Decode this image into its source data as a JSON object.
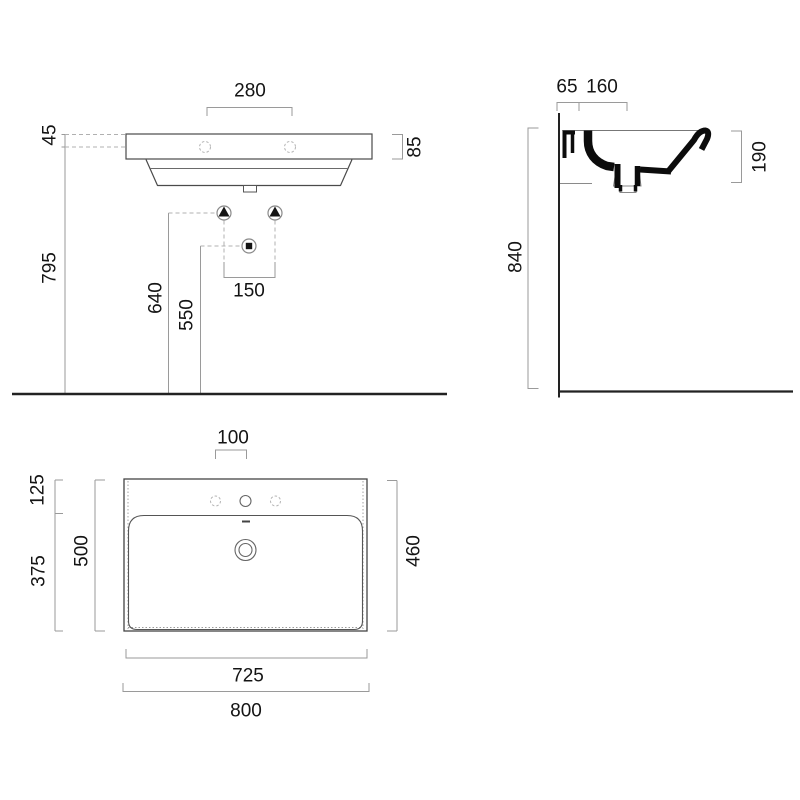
{
  "colors": {
    "background": "#ffffff",
    "outline": "#4a4a4a",
    "section_fill": "#0c0c0c",
    "dimension_line": "#9a9a9a",
    "hidden_line": "#b5b5b5",
    "wall_floor_line": "#222222",
    "text": "#141414"
  },
  "symbols": {
    "water_supply": "triangle-in-circle",
    "waste_outlet": "square-in-circle"
  },
  "front_view": {
    "dims": {
      "hole_spacing": "280",
      "hole_to_rim": "45",
      "rim_height": "85",
      "hole_height": "795",
      "supply_height": "640",
      "waste_height": "550",
      "supply_spacing": "150"
    }
  },
  "side_view": {
    "dims": {
      "wall_to_fixing": "65",
      "fixing_to_waste": "160",
      "basin_depth": "190",
      "rim_height_from_floor": "840"
    }
  },
  "plan_view": {
    "dims": {
      "hole_pitch": "100",
      "back_ledge_depth": "125",
      "bowl_depth": "375",
      "overall_depth": "500",
      "inner_depth": "460",
      "inner_width": "725",
      "overall_width": "800"
    }
  }
}
